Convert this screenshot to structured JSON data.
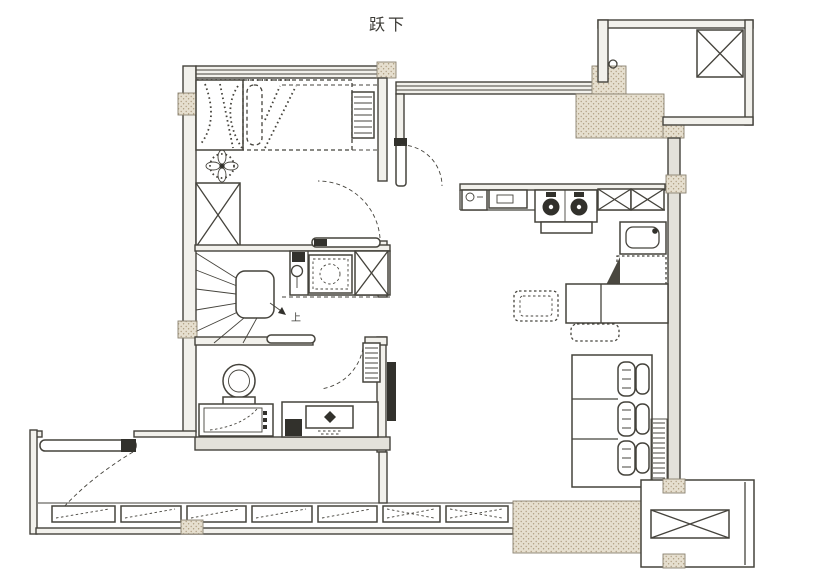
{
  "plan": {
    "title": "跃下",
    "stair_label": "上",
    "colors": {
      "background": "#ffffff",
      "line": "#45433c",
      "wall_fill": "#f2f1ec",
      "wall_shade": "#e3e1da",
      "hatch_bg": "#e6dfcf",
      "hatch_dot": "#b09f85",
      "dark": "#32312c"
    },
    "elements": [
      "bedroom-window",
      "wardrobe",
      "bed",
      "pillow",
      "ceiling-fan",
      "closet-cabinet",
      "winder-staircase",
      "stair-handrail",
      "laundry-counter",
      "washing-machine",
      "sliding-door-leaf",
      "bathroom",
      "toilet",
      "laundry-cabinet",
      "vanity-basin",
      "tv",
      "entry-door",
      "bedroom-door",
      "bathroom-door",
      "balcony-door",
      "kitchen-counter",
      "kitchen-sink",
      "gas-stove",
      "kitchen-cabinets",
      "wall-sink",
      "refrigerator",
      "dining-table",
      "dining-chair",
      "dining-bench",
      "sofa",
      "radiator",
      "balcony-windows",
      "ac-platform-north",
      "ac-platform-south",
      "duct-shaft"
    ]
  }
}
